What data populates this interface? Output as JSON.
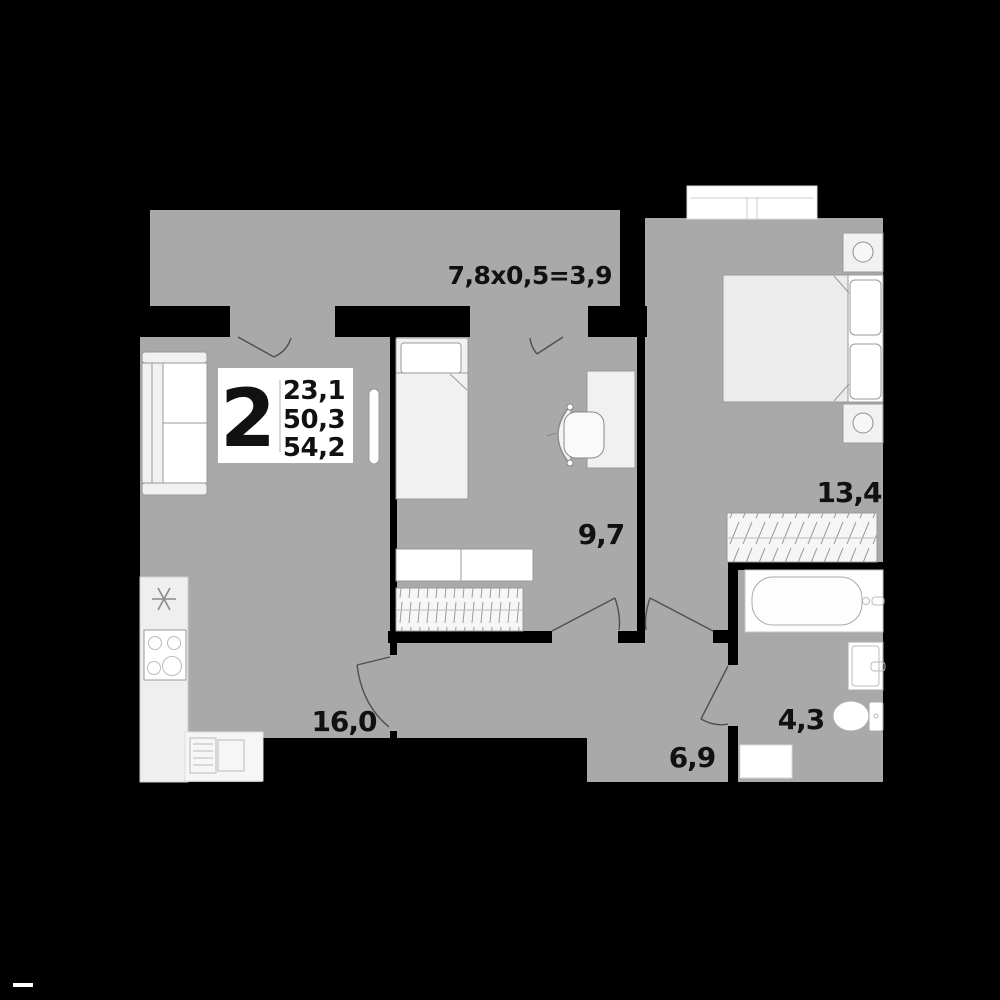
{
  "plan": {
    "unit_badge": {
      "rooms_count": "2",
      "living_area": "23,1",
      "apartment_area": "50,3",
      "total_area": "54,2"
    },
    "balcony_label": "7,8x0,5=3,9",
    "room_areas": {
      "kitchen_living": "16,0",
      "bedroom_small": "9,7",
      "bedroom_master": "13,4",
      "hallway": "6,9",
      "bathroom": "4,3"
    }
  },
  "colors": {
    "bg": "#000000",
    "floor": "#a9a9a9",
    "wall": "#000000",
    "fixture": "#ffffff",
    "fixture_soft": "#f1f1f1",
    "outline": "#999999",
    "arc": "#4f4f4f",
    "ink": "#111111",
    "hatch": "#9a9a9a",
    "divider": "#cccccc"
  }
}
